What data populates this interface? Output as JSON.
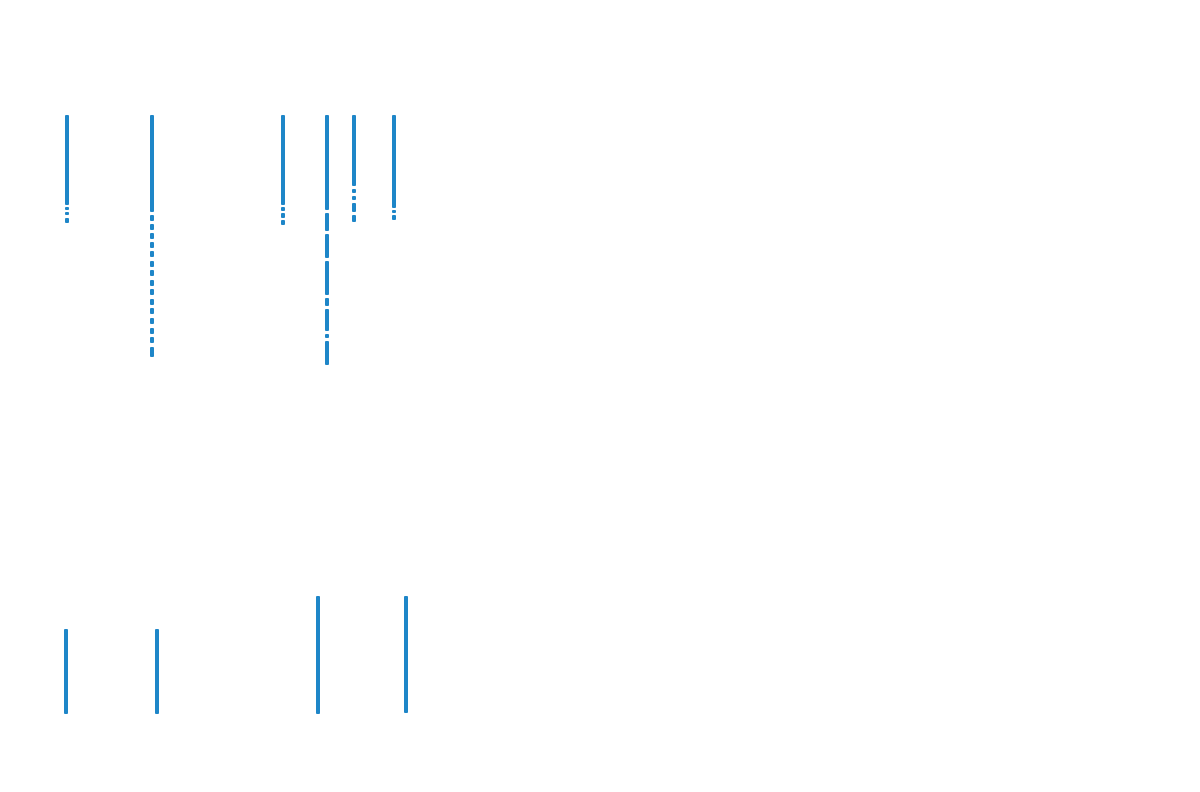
{
  "page": {
    "background": "#ffffff",
    "width": 1200,
    "height": 792,
    "title": "",
    "visible_text": ""
  },
  "chart_data": {
    "type": "scatter",
    "subtype": "vertical-event-ticks",
    "marker": "|",
    "marker_color": "#1e86c8",
    "marker_width_px": 4,
    "background": "#ffffff",
    "axes_visible": false,
    "grid": false,
    "legend": null,
    "title": "",
    "xlabel": "",
    "ylabel": "",
    "note": "No axis labels, ticks, or text are rendered in the image; coordinates below are pixel positions. Each line is a dense stack of vline markers; segments are [y_top, y_bottom] intervals with white gaps between them.",
    "groups": [
      {
        "name": "upper-cluster",
        "lines": [
          {
            "x": 67,
            "segments": [
              [
                115,
                205
              ],
              [
                207,
                210
              ],
              [
                212,
                215
              ],
              [
                218,
                223
              ]
            ]
          },
          {
            "x": 152,
            "segments": [
              [
                115,
                212
              ],
              [
                215,
                221
              ],
              [
                224,
                230
              ],
              [
                233,
                239
              ],
              [
                242,
                248
              ],
              [
                251,
                257
              ],
              [
                261,
                267
              ],
              [
                270,
                276
              ],
              [
                280,
                286
              ],
              [
                289,
                295
              ],
              [
                299,
                305
              ],
              [
                308,
                314
              ],
              [
                318,
                324
              ],
              [
                328,
                334
              ],
              [
                337,
                343
              ],
              [
                347,
                357
              ]
            ]
          },
          {
            "x": 283,
            "segments": [
              [
                115,
                205
              ],
              [
                207,
                211
              ],
              [
                213,
                218
              ],
              [
                220,
                225
              ]
            ]
          },
          {
            "x": 327,
            "segments": [
              [
                115,
                210
              ],
              [
                213,
                231
              ],
              [
                234,
                258
              ],
              [
                261,
                295
              ],
              [
                298,
                306
              ],
              [
                309,
                331
              ],
              [
                334,
                338
              ],
              [
                341,
                365
              ]
            ]
          },
          {
            "x": 354,
            "segments": [
              [
                115,
                186
              ],
              [
                189,
                193
              ],
              [
                196,
                200
              ],
              [
                203,
                212
              ],
              [
                215,
                222
              ]
            ]
          },
          {
            "x": 394,
            "segments": [
              [
                115,
                208
              ],
              [
                210,
                213
              ],
              [
                215,
                220
              ]
            ]
          }
        ]
      },
      {
        "name": "lower-cluster",
        "lines": [
          {
            "x": 66,
            "segments": [
              [
                629,
                714
              ]
            ]
          },
          {
            "x": 157,
            "segments": [
              [
                629,
                714
              ]
            ]
          },
          {
            "x": 318,
            "segments": [
              [
                596,
                714
              ]
            ]
          },
          {
            "x": 406,
            "segments": [
              [
                596,
                713
              ]
            ]
          }
        ]
      }
    ]
  }
}
